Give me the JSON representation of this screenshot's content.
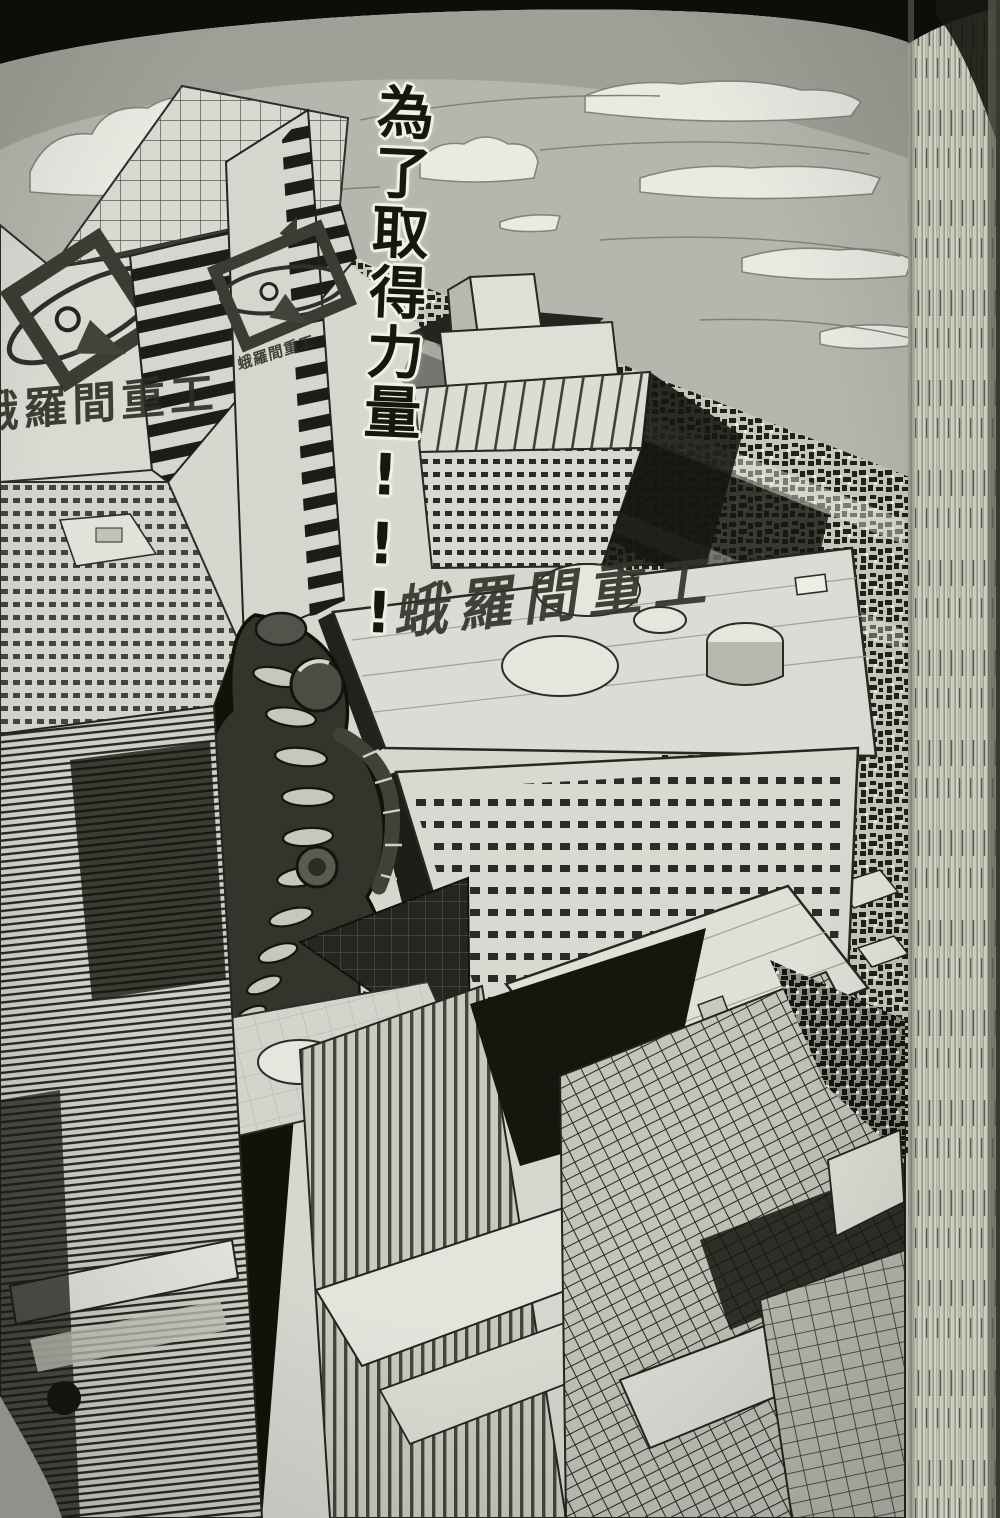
{
  "page": {
    "caption": {
      "text": "為了取得力量!!!"
    },
    "signs": {
      "rooftop": "蛾羅間重工",
      "left_tower": "蛾羅間重工",
      "mid_tower": "蛾羅間重工"
    },
    "icons": {
      "corporate_logo": "diamond-orbit-emblem"
    },
    "colors": {
      "background": "#0c0e0a",
      "paper": "#d7d7d0",
      "ink": "#1c1e18",
      "sky": "#b3b7ad",
      "cloud_white": "#e9eae2",
      "page_edge": "#d3d1c2",
      "creature": "#31352c"
    }
  }
}
